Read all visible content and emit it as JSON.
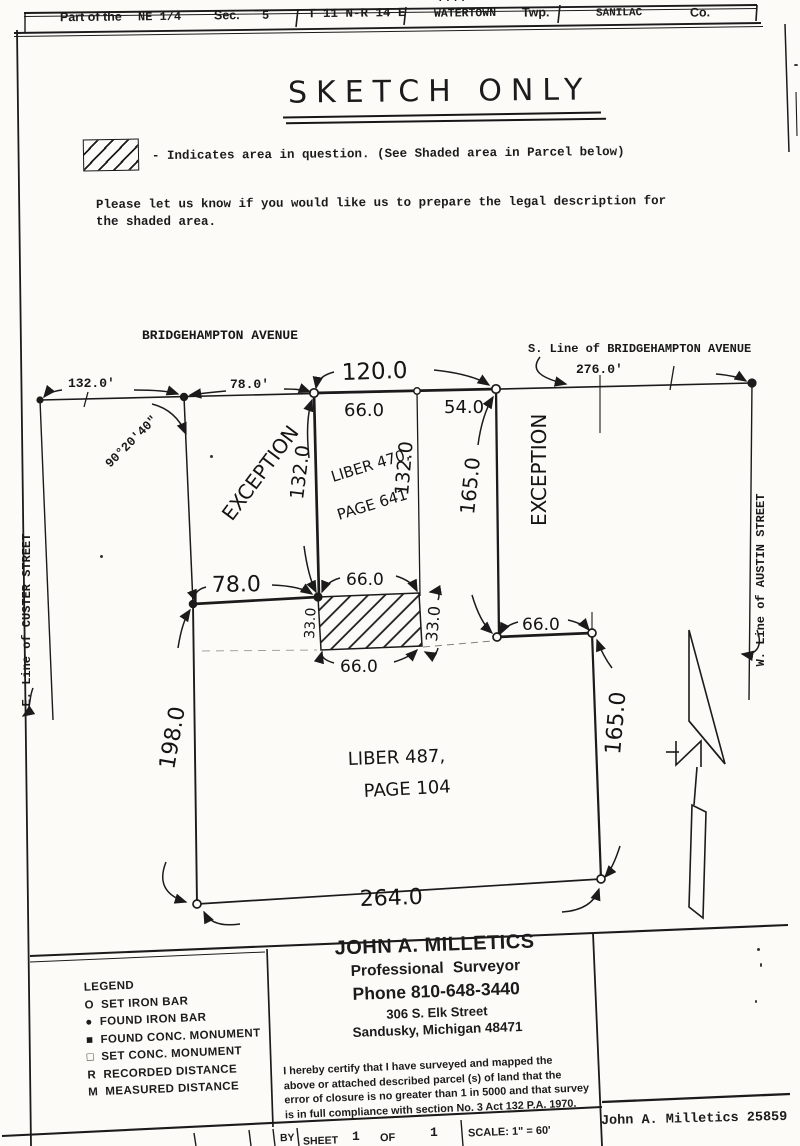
{
  "page": {
    "top_edge_mark": "...."
  },
  "header": {
    "part_label": "Part of the",
    "quarter": "NE 1/4",
    "sec_label": "Sec.",
    "sec_value": "5",
    "town_range": "T 11 N-R 14 E",
    "township": "WATERTOWN",
    "twp_label": "Twp.",
    "county": "SANILAC",
    "co_label": "Co."
  },
  "title": "SKETCH ONLY",
  "notes": {
    "hatch_note": "- Indicates area in question.  (See Shaded area in Parcel below)",
    "request_line1": "Please let us know if you would like us to prepare the legal description for",
    "request_line2": "the shaded area."
  },
  "drawing": {
    "streets": {
      "bridgehampton": "BRIDGEHAMPTON AVENUE",
      "bridgehampton_s_line": "S. Line of BRIDGEHAMPTON AVENUE",
      "custer_e_line": "E. Line of CUSTER STREET",
      "austin_w_line": "W. Line of AUSTIN STREET"
    },
    "top_dims": {
      "d132": "132.0'",
      "d78": "78.0'",
      "d120": "120.0",
      "d276": "276.0'",
      "d66": "66.0",
      "d54": "54.0"
    },
    "angle": "90°20'40\"",
    "exception_left": "EXCEPTION",
    "exception_right": "EXCEPTION",
    "upper_parcel": {
      "line1": "LIBER 470,",
      "line2": "PAGE 641",
      "west_depth": "132.0",
      "east_depth": "132.0",
      "exception_depth": "165.0"
    },
    "mid_dims": {
      "d78": "78.0",
      "d66_top": "66.0",
      "d33_left": "33.0",
      "d33_right": "33.0",
      "d66_bottom": "66.0",
      "d66_east": "66.0"
    },
    "lower_parcel": {
      "line1": "LIBER 487,",
      "line2": "PAGE 104",
      "west": "198.0",
      "east": "165.0",
      "south": "264.0"
    }
  },
  "legend": {
    "title": "LEGEND",
    "items": [
      {
        "symbol": "O",
        "label": "SET IRON BAR"
      },
      {
        "symbol": "●",
        "label": "FOUND IRON BAR"
      },
      {
        "symbol": "■",
        "label": "FOUND CONC. MONUMENT"
      },
      {
        "symbol": "□",
        "label": "SET CONC. MONUMENT"
      },
      {
        "symbol": "R",
        "label": "RECORDED DISTANCE"
      },
      {
        "symbol": "M",
        "label": "MEASURED DISTANCE"
      }
    ]
  },
  "surveyor": {
    "name": "JOHN A. MILLETICS",
    "title": "Professional Surveyor",
    "phone": "Phone 810-648-3440",
    "address1": "306 S. Elk Street",
    "address2": "Sandusky, Michigan 48471"
  },
  "certification": {
    "line1": "I hereby certify that I have surveyed and mapped the",
    "line2": "above or attached described parcel (s) of land that the",
    "line3": "error of closure is no greater than 1 in 5000 and that survey",
    "line4": "is in full compliance with section No. 3 Act 132 P.A. 1970."
  },
  "footer": {
    "by_label": "BY",
    "sheet_label": "SHEET",
    "sheet_value": "1",
    "of_label": "OF",
    "of_value": "1",
    "scale": "SCALE: 1\" = 60'",
    "signature": "John A. Milletics 25859"
  }
}
